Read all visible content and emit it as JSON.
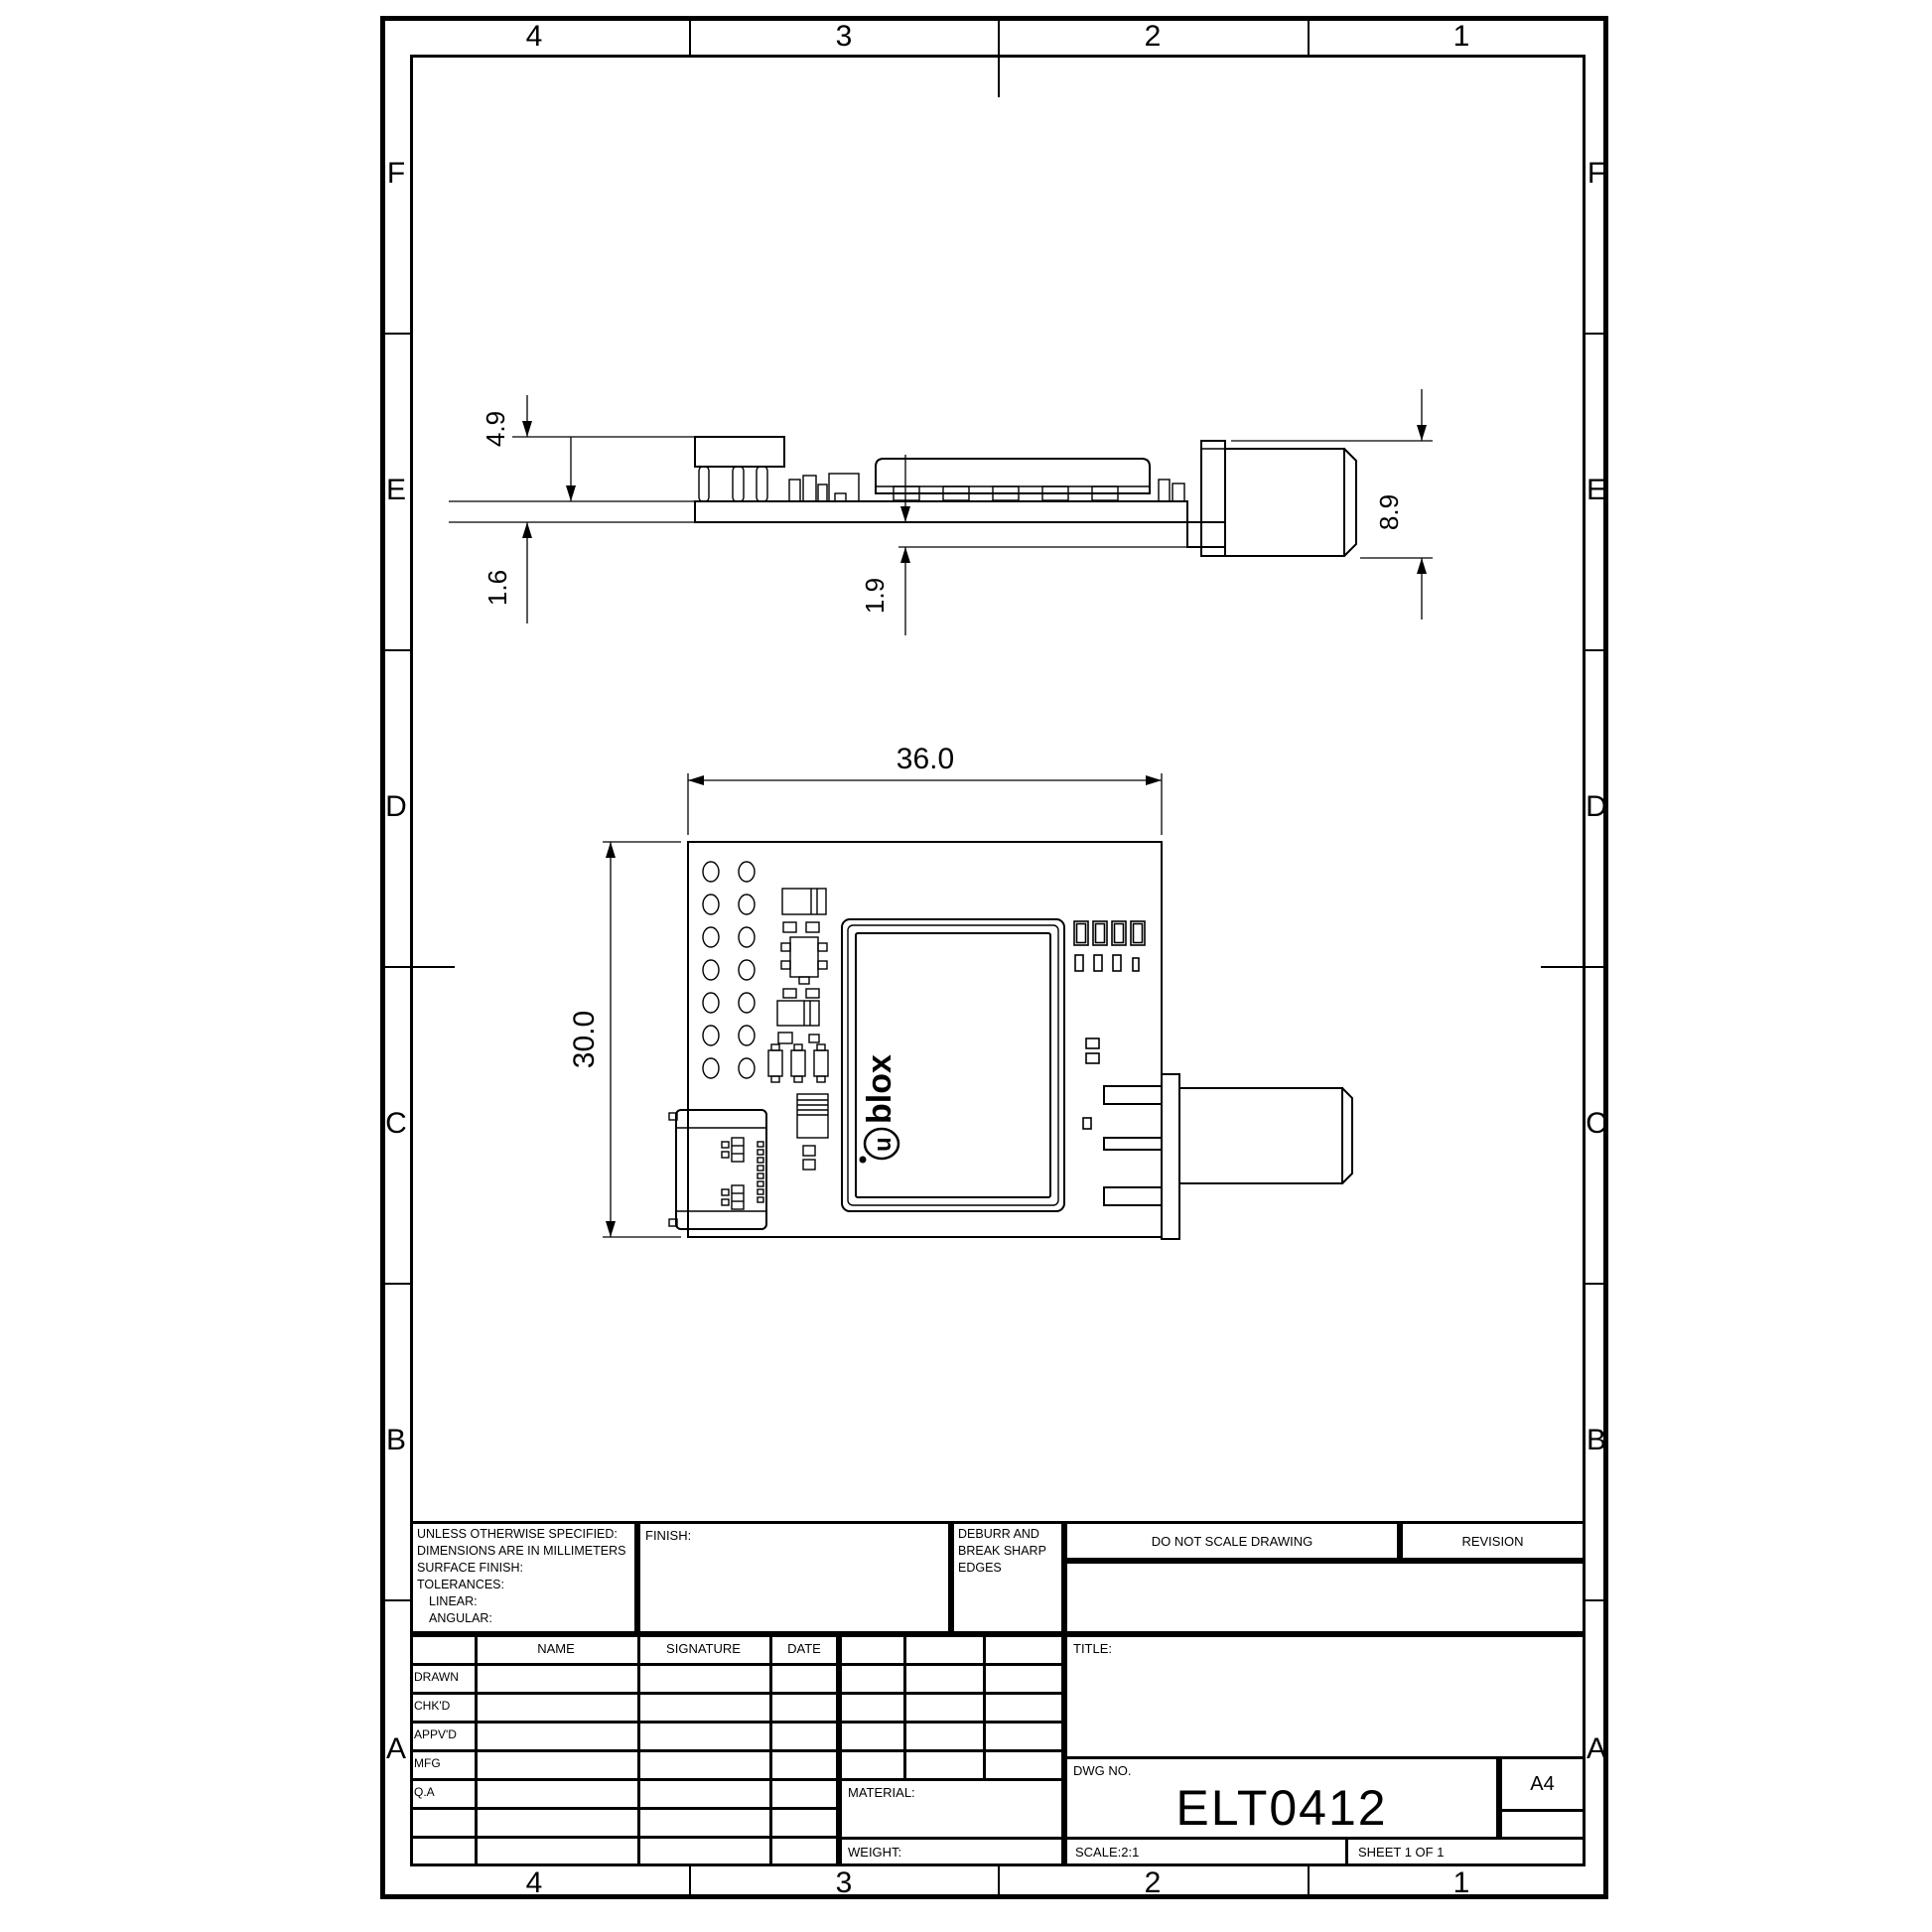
{
  "sheet": {
    "border_rows": [
      "F",
      "E",
      "D",
      "C",
      "B",
      "A"
    ],
    "border_cols": [
      "4",
      "3",
      "2",
      "1"
    ]
  },
  "title_block": {
    "tolerance_lines": [
      "UNLESS OTHERWISE SPECIFIED:",
      "DIMENSIONS ARE IN MILLIMETERS",
      "SURFACE FINISH:",
      "TOLERANCES:",
      "LINEAR:",
      "ANGULAR:"
    ],
    "finish_label": "FINISH:",
    "deburr_lines": [
      "DEBURR AND",
      "BREAK SHARP",
      "EDGES"
    ],
    "do_not_scale": "DO NOT SCALE DRAWING",
    "revision_label": "REVISION",
    "name_header": "NAME",
    "signature_header": "SIGNATURE",
    "date_header": "DATE",
    "row_labels": [
      "DRAWN",
      "CHK'D",
      "APPV'D",
      "MFG",
      "Q.A"
    ],
    "title_label": "TITLE:",
    "material_label": "MATERIAL:",
    "weight_label": "WEIGHT:",
    "dwg_no_label": "DWG NO.",
    "dwg_no_value": "ELT0412",
    "sheet_size": "A4",
    "scale_label": "SCALE:2:1",
    "sheet_label": "SHEET 1 OF 1"
  },
  "dimensions": {
    "board_width": "36.0",
    "board_height": "30.0",
    "component_height": "4.9",
    "pcb_thickness": "1.6",
    "connector_drop": "1.9",
    "connector_height": "8.9"
  },
  "logo": {
    "glyph": "u",
    "text": "blox"
  }
}
